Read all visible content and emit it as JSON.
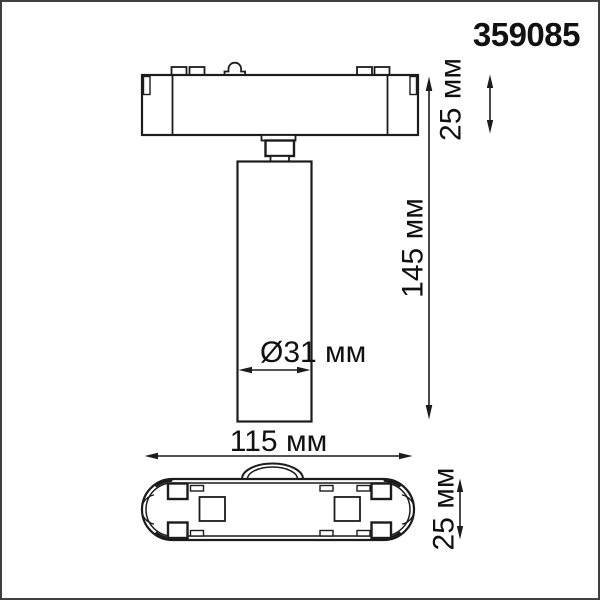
{
  "product_code": "359085",
  "dimensions": {
    "base_height": "25 мм",
    "overall_height": "145 мм",
    "spot_diameter": "Ø31 мм",
    "base_width": "115 мм",
    "base_depth": "25 мм"
  },
  "colors": {
    "background": "#ffffff",
    "line": "#1c1c1c",
    "text": "#111111",
    "frame": "#3f3f3f"
  }
}
